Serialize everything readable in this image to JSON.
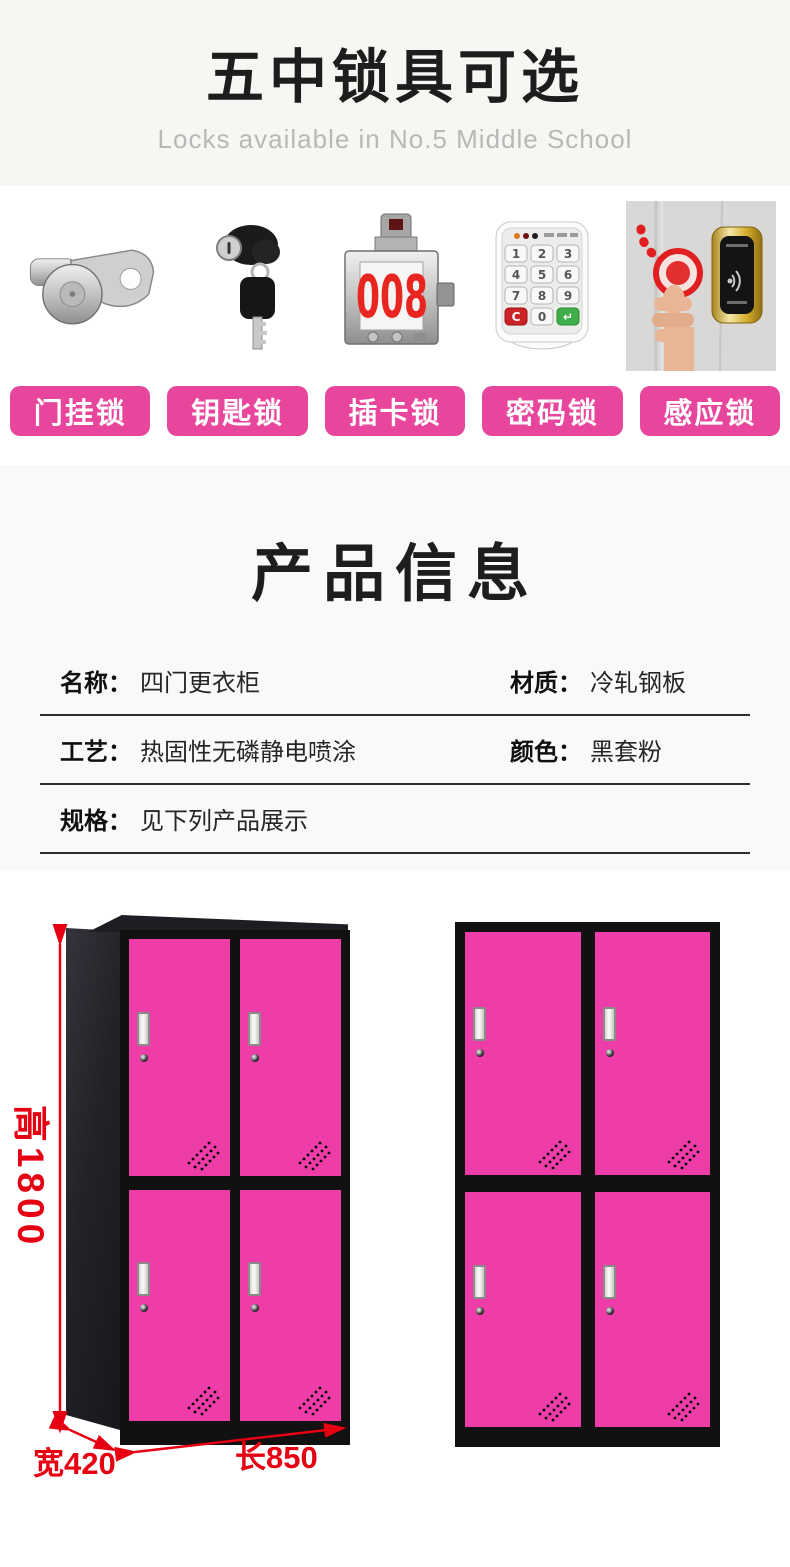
{
  "header": {
    "title": "五中锁具可选",
    "subtitle": "Locks available in No.5 Middle School"
  },
  "locks": {
    "items": [
      {
        "label": "门挂锁",
        "image": "cam-lock"
      },
      {
        "label": "钥匙锁",
        "image": "key-lock"
      },
      {
        "label": "插卡锁",
        "image": "card-lock",
        "display_number": "008"
      },
      {
        "label": "密码锁",
        "image": "keypad-lock",
        "keys": [
          "1",
          "2",
          "3",
          "4",
          "5",
          "6",
          "7",
          "8",
          "9",
          "C",
          "0",
          "↵"
        ]
      },
      {
        "label": "感应锁",
        "image": "induction-lock"
      }
    ]
  },
  "product_info": {
    "title": "产品信息",
    "rows": [
      [
        {
          "label": "名称：",
          "value": "四门更衣柜"
        },
        {
          "label": "材质：",
          "value": "冷轧钢板"
        }
      ],
      [
        {
          "label": "工艺：",
          "value": "热固性无磷静电喷涂"
        },
        {
          "label": "颜色：",
          "value": "黑套粉"
        }
      ],
      [
        {
          "label": "规格：",
          "value": "见下列产品展示"
        }
      ]
    ]
  },
  "dimensions": {
    "height": "高1800",
    "width": "宽420",
    "length": "长850"
  },
  "colors": {
    "accent_pink": "#e8459c",
    "door_pink": "#ee3ca8",
    "frame_black": "#111111",
    "dimension_red": "#e60012",
    "display_red": "#e8251f",
    "title_black": "#1d1d1d",
    "subtitle_gray": "#b8b8b8",
    "header_bg": "#f7f6f3",
    "info_bg": "#faf9f7"
  }
}
